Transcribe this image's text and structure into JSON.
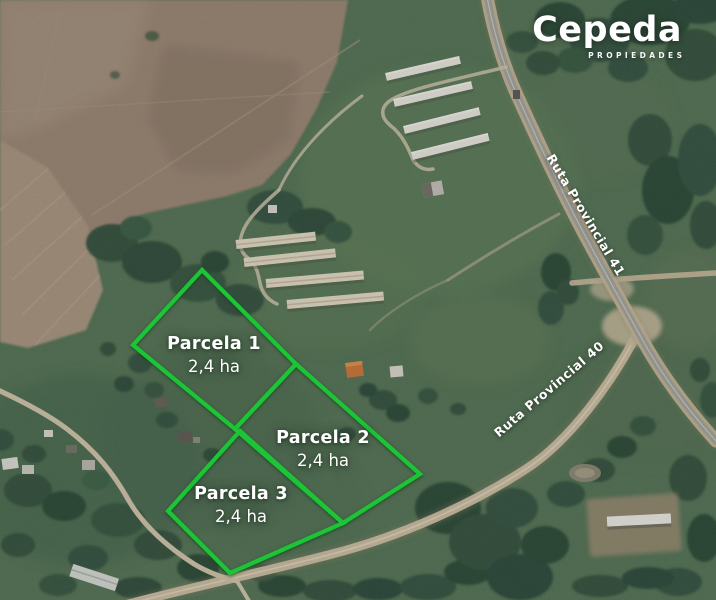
{
  "brand": {
    "name": "Cepeda",
    "tagline": "PROPIEDADES"
  },
  "parcels": [
    {
      "name": "Parcela 1",
      "area": "2,4 ha"
    },
    {
      "name": "Parcela 2",
      "area": "2,4 ha"
    },
    {
      "name": "Parcela 3",
      "area": "2,4 ha"
    }
  ],
  "roads": {
    "r41": {
      "label": "Ruta Provincial 41"
    },
    "r40": {
      "label": "Ruta Provincial 40"
    }
  },
  "colors": {
    "parcel_outline": "#0dde2e",
    "label_text": "#ffffff"
  }
}
